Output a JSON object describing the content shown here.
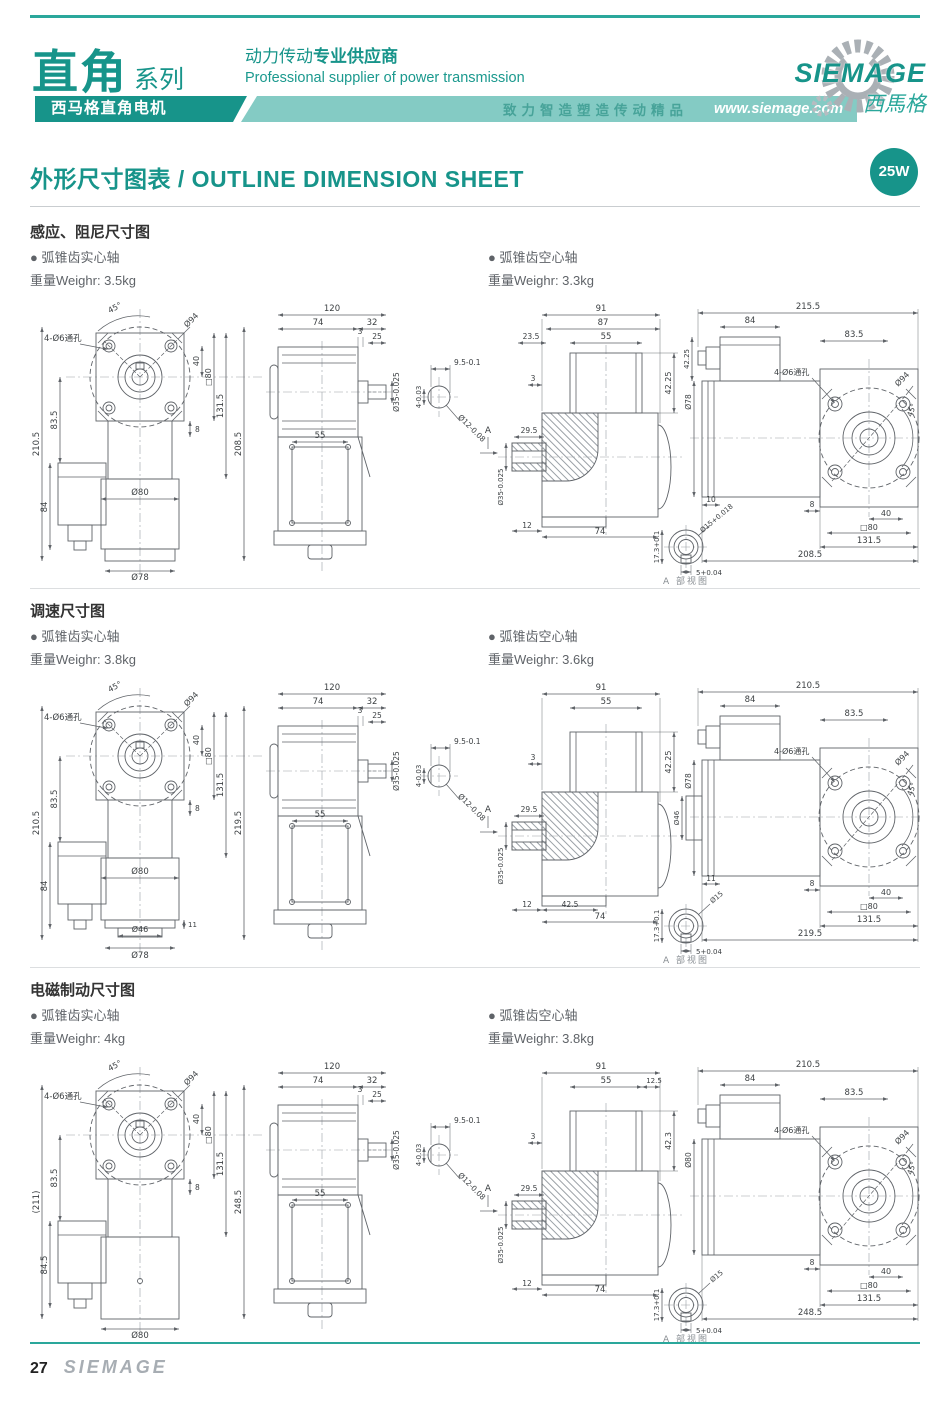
{
  "header": {
    "series_cn": "直角",
    "series_suffix": "系列",
    "tagline_cn_normal": "动力传动",
    "tagline_cn_bold": "专业供应商",
    "tagline_en": "Professional supplier of power transmission",
    "banner_product": "西马格直角电机",
    "banner_slogan": "致力智造塑造传动精品",
    "website": "www.siemage.com",
    "logo_text": "SIEMAGE",
    "logo_cn": "西馬格"
  },
  "title": {
    "text": "外形尺寸图表 / OUTLINE DIMENSION SHEET",
    "badge": "25W"
  },
  "colors": {
    "teal": "#17948a",
    "teal_light": "#84cbc4",
    "logo_gray": "#aab0b5"
  },
  "footer": {
    "page_number": "27",
    "brand": "SIEMAGE"
  },
  "sections": [
    {
      "title": "感应、阻尼尺寸图",
      "left_variant": {
        "bullet": "● 弧锥齿实心轴",
        "weight": "重量Weighr: 3.5kg"
      },
      "right_variant": {
        "bullet": "● 弧锥齿空心轴",
        "weight": "重量Weighr: 3.3kg"
      },
      "front": {
        "v_total": "210.5",
        "v_upper": "83.5",
        "v_box": "84",
        "angle": "45°",
        "flange": "Ø94",
        "holes": "4-Ø6通孔",
        "hole_off": "40",
        "square": "□80",
        "inner": "131.5",
        "total_r": "208.5",
        "step": "8",
        "body": "Ø80",
        "base": "Ø78"
      },
      "side": {
        "total": "120",
        "gear": "74",
        "ext": "32",
        "gap": "3",
        "shaft": "25",
        "shaft_dia": "Ø35-0.025",
        "box": "55"
      },
      "key": {
        "w": "9.5-0.1",
        "d": "4-0.03",
        "dia": "Ø12-0.08"
      },
      "sect": {
        "t1": "91",
        "t2": "87",
        "t3": "23.5",
        "t4": "55",
        "gap": "3",
        "h": "42.25",
        "hub": "29.5",
        "bore": "Ø35-0.025",
        "b1": "12",
        "b2": "74",
        "arrow": "A"
      },
      "detail": {
        "h": "17.3+0.1",
        "dia": "Ø15+0.018",
        "w": "5+0.04",
        "caption": "A 部视图"
      },
      "motor": {
        "total": "215.5",
        "box": "84",
        "upper": "83.5",
        "holes": "4-Ø6通孔",
        "flange": "Ø94",
        "angle": "45°",
        "body": "Ø78",
        "boxh": "42.25",
        "left": "10",
        "step": "8",
        "hole_off": "40",
        "square": "□80",
        "inner": "131.5",
        "total_b": "208.5"
      }
    },
    {
      "title": "调速尺寸图",
      "left_variant": {
        "bullet": "● 弧锥齿实心轴",
        "weight": "重量Weighr: 3.8kg"
      },
      "right_variant": {
        "bullet": "● 弧锥齿空心轴",
        "weight": "重量Weighr: 3.6kg"
      },
      "front": {
        "v_total": "210.5",
        "v_upper": "83.5",
        "v_box": "84",
        "angle": "45°",
        "flange": "Ø94",
        "holes": "4-Ø6通孔",
        "hole_off": "40",
        "square": "□80",
        "inner": "131.5",
        "total_r": "219.5",
        "step": "8",
        "body": "Ø80",
        "base": "Ø78",
        "base2": "Ø46",
        "base_step": "11"
      },
      "side": {
        "total": "120",
        "gear": "74",
        "ext": "32",
        "gap": "3",
        "shaft": "25",
        "shaft_dia": "Ø35-0.025",
        "box": "55"
      },
      "key": {
        "w": "9.5-0.1",
        "d": "4-0.03",
        "dia": "Ø12-0.08"
      },
      "sect": {
        "t1": "91",
        "t4": "55",
        "gap": "3",
        "h": "42.25",
        "hub": "29.5",
        "bore": "Ø35-0.025",
        "b1": "12",
        "b_mid": "42.5",
        "b2": "74",
        "arrow": "A"
      },
      "detail": {
        "h": "17.3+0.1",
        "dia": "Ø15",
        "w": "5+0.04",
        "caption": "A 部视图"
      },
      "motor": {
        "total": "210.5",
        "box": "84",
        "upper": "83.5",
        "holes": "4-Ø6通孔",
        "flange": "Ø94",
        "angle": "45°",
        "body": "Ø78",
        "body2": "Ø46",
        "left": "11",
        "step": "8",
        "hole_off": "40",
        "square": "□80",
        "inner": "131.5",
        "total_b": "219.5"
      }
    },
    {
      "title": "电磁制动尺寸图",
      "left_variant": {
        "bullet": "● 弧锥齿实心轴",
        "weight": "重量Weighr: 4kg"
      },
      "right_variant": {
        "bullet": "● 弧锥齿空心轴",
        "weight": "重量Weighr: 3.8kg"
      },
      "front": {
        "v_total": "(211)",
        "v_upper": "83.5",
        "v_box": "84.5",
        "angle": "45°",
        "flange": "Ø94",
        "holes": "4-Ø6通孔",
        "hole_off": "40",
        "square": "□80",
        "inner": "131.5",
        "total_r": "248.5",
        "step": "8",
        "body": "Ø80"
      },
      "side": {
        "total": "120",
        "gear": "74",
        "ext": "32",
        "gap": "3",
        "shaft": "25",
        "shaft_dia": "Ø35-0.025",
        "box": "55"
      },
      "key": {
        "w": "9.5-0.1",
        "d": "4-0.03",
        "dia": "Ø12-0.08"
      },
      "sect": {
        "t1": "91",
        "t4": "55",
        "t5": "12.5",
        "gap": "3",
        "h": "42.3",
        "hub": "29.5",
        "bore": "Ø35-0.025",
        "b1": "12",
        "b2": "74",
        "arrow": "A"
      },
      "detail": {
        "h": "17.3+0.1",
        "dia": "Ø15",
        "w": "5+0.04",
        "caption": "A 部视图"
      },
      "motor": {
        "total": "210.5",
        "box": "84",
        "upper": "83.5",
        "holes": "4-Ø6通孔",
        "flange": "Ø94",
        "angle": "45°",
        "body": "Ø80",
        "step": "8",
        "hole_off": "40",
        "square": "□80",
        "inner": "131.5",
        "total_b": "248.5"
      }
    }
  ]
}
